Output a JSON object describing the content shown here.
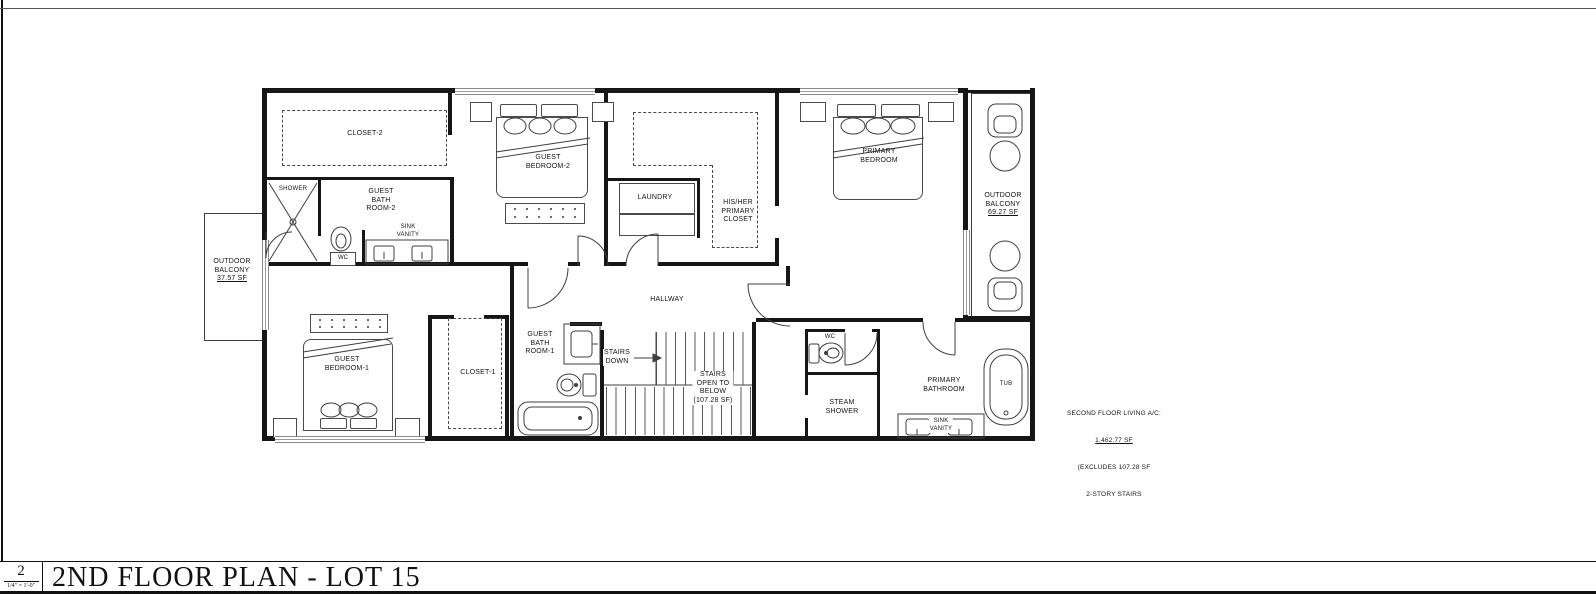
{
  "ink": "#161616",
  "rooms": {
    "closet2": {
      "lines": [
        "CLOSET-2"
      ]
    },
    "guest_bedroom2": {
      "lines": [
        "GUEST",
        "BEDROOM-2"
      ]
    },
    "shower": {
      "lines": [
        "SHOWER"
      ]
    },
    "guest_bath2": {
      "lines": [
        "GUEST",
        "BATH",
        "ROOM-2"
      ]
    },
    "wc2": {
      "lines": [
        "WC"
      ]
    },
    "sink_vanity2": {
      "lines": [
        "SINK",
        "VANITY"
      ]
    },
    "laundry": {
      "lines": [
        "LAUNDRY"
      ]
    },
    "his_her_closet": {
      "lines": [
        "HIS/HER",
        "PRIMARY",
        "CLOSET"
      ]
    },
    "primary_bedroom": {
      "lines": [
        "PRIMARY",
        "BEDROOM"
      ]
    },
    "balcony_right": {
      "lines": [
        "OUTDOOR",
        "BALCONY",
        "69.27 SF"
      ]
    },
    "balcony_left": {
      "lines": [
        "OUTDOOR",
        "BALCONY",
        "37.57 SF"
      ]
    },
    "hallway": {
      "lines": [
        "HALLWAY"
      ]
    },
    "guest_bath1": {
      "lines": [
        "GUEST",
        "BATH",
        "ROOM-1"
      ]
    },
    "guest_bedroom1": {
      "lines": [
        "GUEST",
        "BEDROOM-1"
      ]
    },
    "closet1": {
      "lines": [
        "CLOSET-1"
      ]
    },
    "stairs_down": {
      "lines": [
        "STAIRS",
        "DOWN"
      ]
    },
    "stairs_open": {
      "lines": [
        "STAIRS",
        "OPEN TO",
        "BELOW",
        "(107.28 SF)"
      ]
    },
    "wc_primary": {
      "lines": [
        "WC"
      ]
    },
    "steam_shower": {
      "lines": [
        "STEAM",
        "SHOWER"
      ]
    },
    "primary_bathroom": {
      "lines": [
        "PRIMARY",
        "BATHROOM"
      ]
    },
    "sink_vanity_primary": {
      "lines": [
        "SINK",
        "VANITY"
      ]
    },
    "tub": {
      "lines": [
        "TUB"
      ]
    }
  },
  "area_note": {
    "lines": [
      "SECOND FLOOR LIVING A/C:",
      "1,462.77 SF",
      "(EXCLUDES 107.28 SF",
      "2-STORY STAIRS"
    ]
  },
  "title_block": {
    "sheet_number": "2",
    "scale": "1/4\" = 1'-0\"",
    "title": "2ND FLOOR PLAN - LOT 15"
  }
}
